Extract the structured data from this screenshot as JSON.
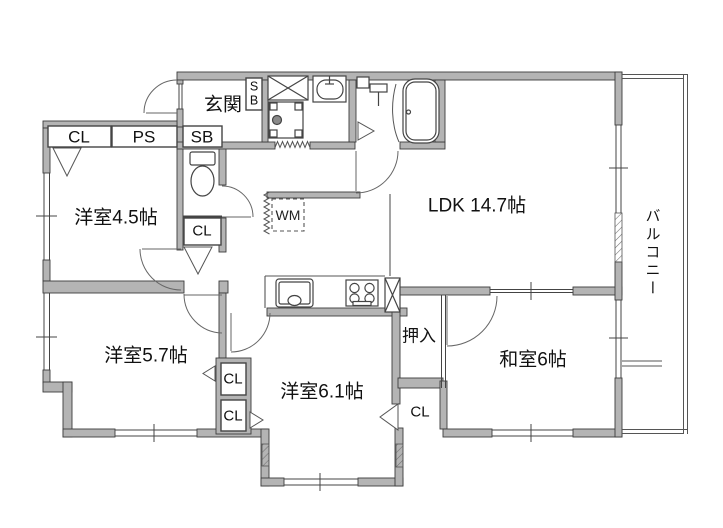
{
  "floor_plan": {
    "title": "apartment-floor-plan",
    "labels": {
      "entrance": "玄関",
      "shoe_box_vertical": "S\nB",
      "closet_1": "CL",
      "pipe_space": "PS",
      "shoe_box": "SB",
      "western_room_45": "洋室4.5帖",
      "closet_2": "CL",
      "washing_machine": "WM",
      "ldk": "LDK 14.7帖",
      "balcony": "バルコニー",
      "western_room_57": "洋室5.7帖",
      "closet_3": "CL",
      "closet_4": "CL",
      "western_room_61": "洋室6.1帖",
      "oshiire": "押入",
      "japanese_room": "和室6帖",
      "closet_5": "CL"
    },
    "colors": {
      "wall_fill": "#b4b4b4",
      "wall_outline": "#3c3c3c",
      "line": "#555555",
      "text": "#111111",
      "background": "#ffffff"
    }
  }
}
